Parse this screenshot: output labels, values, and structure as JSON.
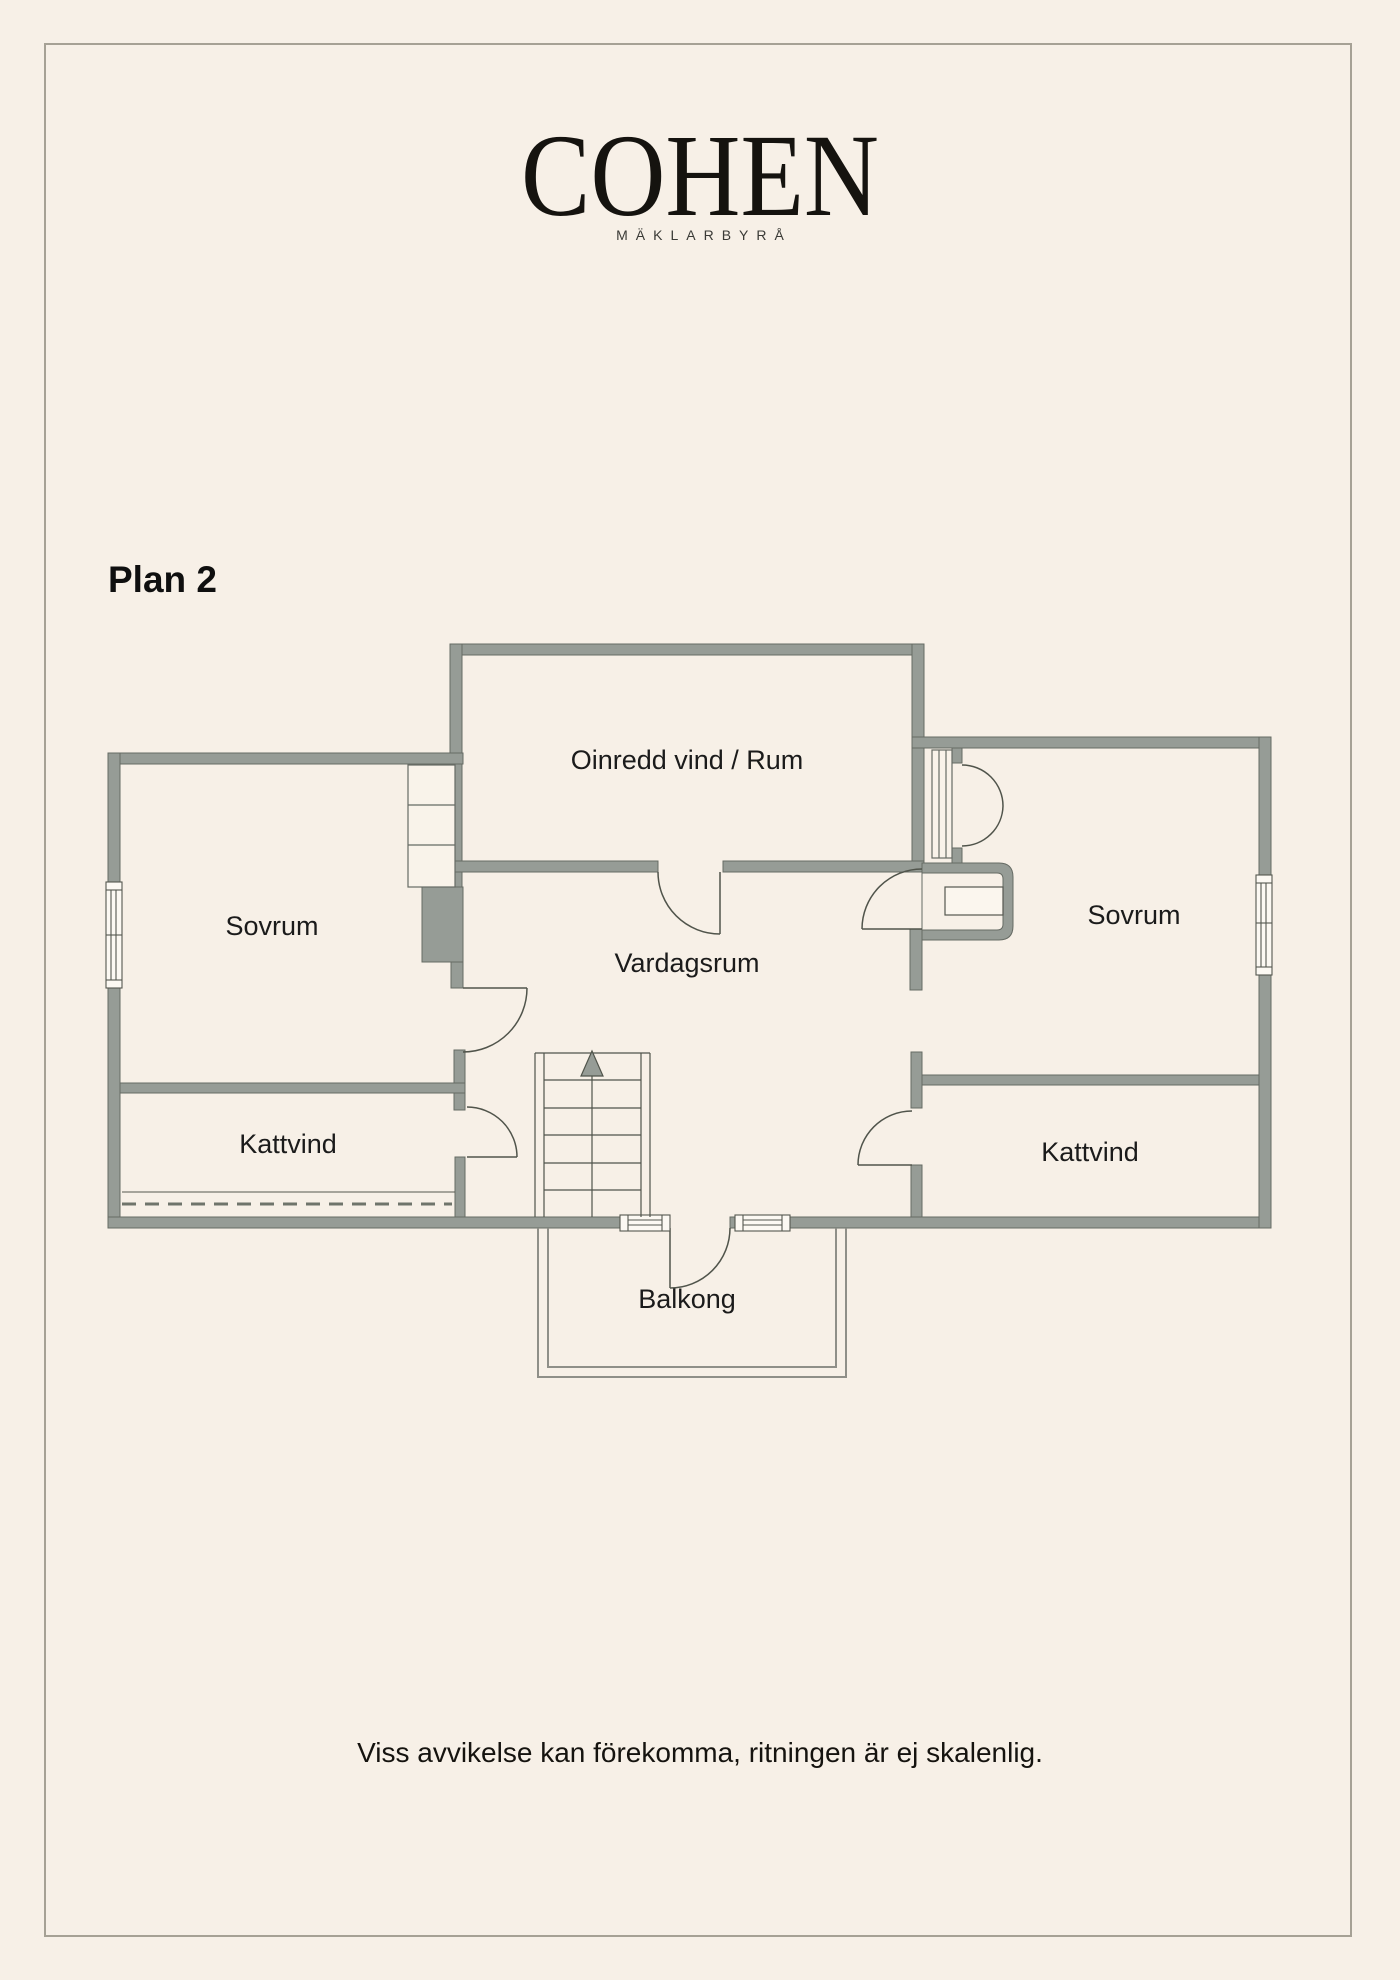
{
  "brand": {
    "logo": "COHEN",
    "tagline": "MÄKLARBYRÅ"
  },
  "page": {
    "title": "Plan 2",
    "disclaimer": "Viss avvikelse kan förekomma, ritningen är ej skalenlig."
  },
  "floorplan": {
    "rooms": {
      "attic_room": "Oinredd vind / Rum",
      "bedroom_left": "Sovrum",
      "living_room": "Vardagsrum",
      "bedroom_right": "Sovrum",
      "crawl_space_left": "Kattvind",
      "crawl_space_right": "Kattvind",
      "balcony": "Balkong"
    },
    "colors": {
      "background": "#f7f0e7",
      "wall_fill": "#969c96",
      "wall_outline": "#666b64",
      "thin_line": "#50544b",
      "frame": "#a6a195",
      "window_fill": "#fcf9f3"
    }
  }
}
